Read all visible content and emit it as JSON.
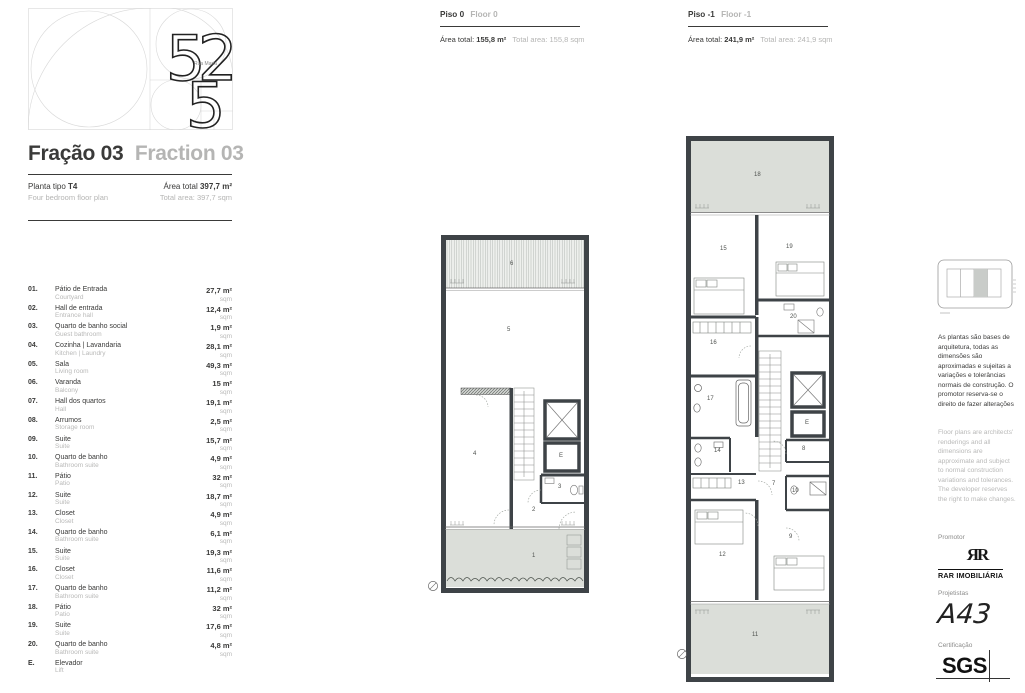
{
  "brand": {
    "digits": [
      "5",
      "2",
      "5"
    ],
    "logo_caption": "Rua Maria"
  },
  "header": {
    "fraction_pt": "Fração 03",
    "fraction_en": "Fraction 03",
    "plan_type_label": "Planta tipo",
    "plan_type_value": "T4",
    "plan_type_en": "Four bedroom floor plan",
    "total_area_label": "Área total",
    "total_area_value": "397,7 m²",
    "total_area_en": "Total area: 397,7 sqm"
  },
  "room_list": [
    {
      "num": "01.",
      "pt": "Pátio de Entrada",
      "en": "Courtyard",
      "area": "27,7 m²",
      "area_en": "sqm"
    },
    {
      "num": "02.",
      "pt": "Hall de entrada",
      "en": "Entrance hall",
      "area": "12,4 m²",
      "area_en": "sqm"
    },
    {
      "num": "03.",
      "pt": "Quarto de banho social",
      "en": "Guest bathroom",
      "area": "1,9 m²",
      "area_en": "sqm"
    },
    {
      "num": "04.",
      "pt": "Cozinha | Lavandaria",
      "en": "Kitchen | Laundry",
      "area": "28,1 m²",
      "area_en": "sqm"
    },
    {
      "num": "05.",
      "pt": "Sala",
      "en": "Living room",
      "area": "49,3 m²",
      "area_en": "sqm"
    },
    {
      "num": "06.",
      "pt": "Varanda",
      "en": "Balcony",
      "area": "15 m²",
      "area_en": "sqm"
    },
    {
      "num": "07.",
      "pt": "Hall dos quartos",
      "en": "Hall",
      "area": "19,1 m²",
      "area_en": "sqm"
    },
    {
      "num": "08.",
      "pt": "Arrumos",
      "en": "Storage room",
      "area": "2,5 m²",
      "area_en": "sqm"
    },
    {
      "num": "09.",
      "pt": "Suite",
      "en": "Suite",
      "area": "15,7 m²",
      "area_en": "sqm"
    },
    {
      "num": "10.",
      "pt": "Quarto de banho",
      "en": "Bathroom suite",
      "area": "4,9 m²",
      "area_en": "sqm"
    },
    {
      "num": "11.",
      "pt": "Pátio",
      "en": "Patio",
      "area": "32 m²",
      "area_en": "sqm"
    },
    {
      "num": "12.",
      "pt": "Suite",
      "en": "Suite",
      "area": "18,7 m²",
      "area_en": "sqm"
    },
    {
      "num": "13.",
      "pt": "Closet",
      "en": "Closet",
      "area": "4,9 m²",
      "area_en": "sqm"
    },
    {
      "num": "14.",
      "pt": "Quarto de banho",
      "en": "Bathroom suite",
      "area": "6,1 m²",
      "area_en": "sqm"
    },
    {
      "num": "15.",
      "pt": "Suite",
      "en": "Suite",
      "area": "19,3 m²",
      "area_en": "sqm"
    },
    {
      "num": "16.",
      "pt": "Closet",
      "en": "Closet",
      "area": "11,6 m²",
      "area_en": "sqm"
    },
    {
      "num": "17.",
      "pt": "Quarto de banho",
      "en": "Bathroom suite",
      "area": "11,2 m²",
      "area_en": "sqm"
    },
    {
      "num": "18.",
      "pt": "Pátio",
      "en": "Patio",
      "area": "32 m²",
      "area_en": "sqm"
    },
    {
      "num": "19.",
      "pt": "Suite",
      "en": "Suite",
      "area": "17,6 m²",
      "area_en": "sqm"
    },
    {
      "num": "20.",
      "pt": "Quarto de banho",
      "en": "Bathroom suite",
      "area": "4,8 m²",
      "area_en": "sqm"
    },
    {
      "num": "E.",
      "pt": "Elevador",
      "en": "Lift",
      "area": "",
      "area_en": ""
    }
  ],
  "floor0": {
    "name_pt": "Piso 0",
    "name_en": "Floor 0",
    "area_label": "Área total:",
    "area_value": "155,8 m²",
    "area_en": "Total area: 155,8 sqm",
    "labels": [
      "6",
      "5",
      "4",
      "2",
      "3",
      "E",
      "1"
    ]
  },
  "floor1": {
    "name_pt": "Piso -1",
    "name_en": "Floor -1",
    "area_label": "Área total:",
    "area_value": "241,9 m²",
    "area_en": "Total area: 241,9 sqm",
    "labels": [
      "18",
      "15",
      "19",
      "20",
      "16",
      "17",
      "14",
      "13",
      "7",
      "8",
      "E",
      "10",
      "12",
      "9",
      "11"
    ]
  },
  "sidebar": {
    "disclaimer_pt": "As plantas são bases de arquitetura, todas as dimensões são aproximadas e sujeitas a variações e tolerâncias normais de construção. O promotor reserva-se o direito de fazer alterações",
    "disclaimer_en": "Floor plans are architects' renderings and all dimensions are approximate and subject to normal construction variations and tolerances. The developer reserves the right to make changes.",
    "promoter_label": "Promotor",
    "promoter_monogram": "ЯR",
    "promoter_name": "RAR IMOBILIÁRIA",
    "designers_label": "Projetistas",
    "designers_name": "A43",
    "certification_label": "Certificação",
    "certification_name": "SGS"
  },
  "colors": {
    "text_dark": "#3a3a39",
    "text_light": "#b9b9b8",
    "wall": "#3e4347",
    "patio_fill": "#dbded9"
  }
}
